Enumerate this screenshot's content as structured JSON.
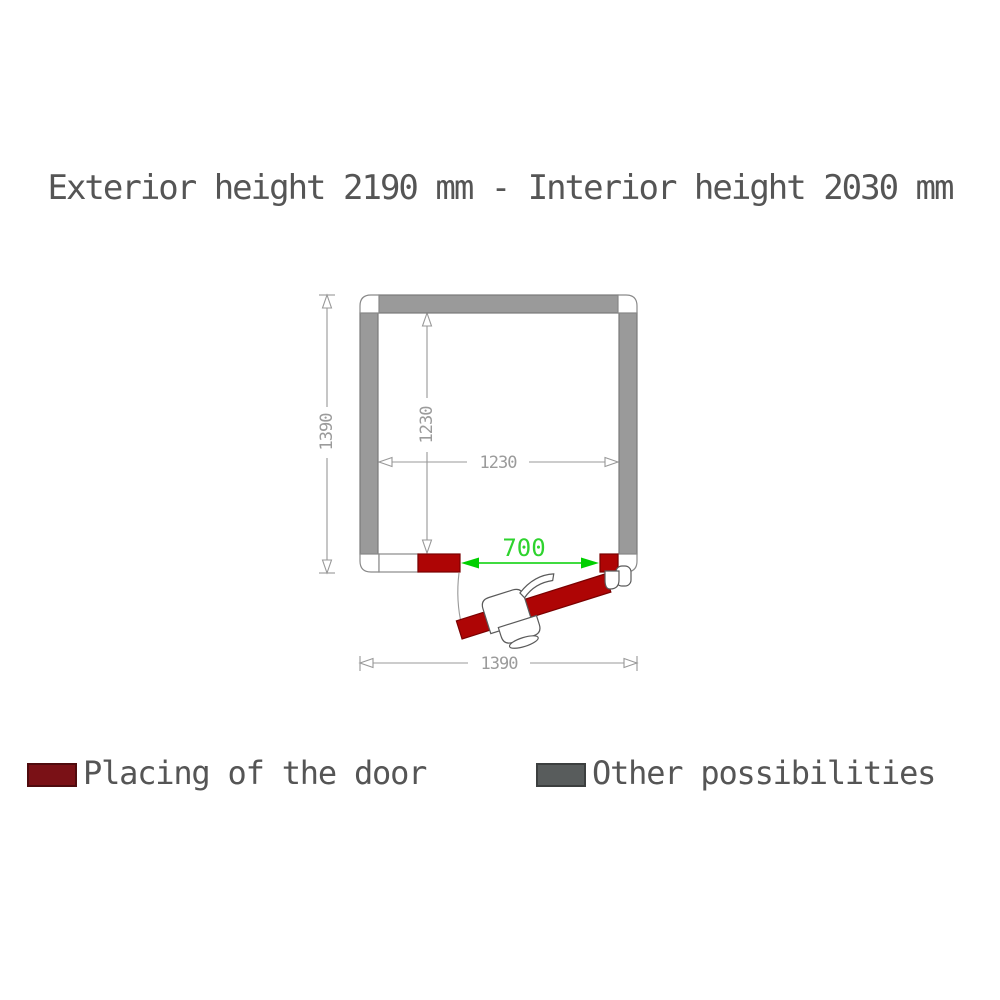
{
  "title": "Exterior height 2190 mm - Interior height 2030 mm",
  "diagram": {
    "dimensions": {
      "exterior_height_side": "1390",
      "interior_height_side": "1230",
      "interior_width": "1230",
      "door_opening": "700",
      "exterior_width": "1390"
    }
  },
  "legend": {
    "items": [
      {
        "label": "Placing of the door",
        "color": "#7a1116",
        "border": "#4f0b0e"
      },
      {
        "label": "Other possibilities",
        "color": "#585c5c",
        "border": "#3c3f3f"
      }
    ]
  },
  "colors": {
    "wall_gray": "#9a9a9a",
    "wall_stroke": "#7a7a7a",
    "white_piece_stroke": "#8a8a8a",
    "door_red": "#ae0505",
    "door_red_stroke": "#7a0000",
    "dimension_gray": "#989898",
    "dimension_text_gray": "#9b9b9b",
    "door_dimension_green": "#00cf00",
    "door_dimension_text_green": "#2ed32e"
  }
}
